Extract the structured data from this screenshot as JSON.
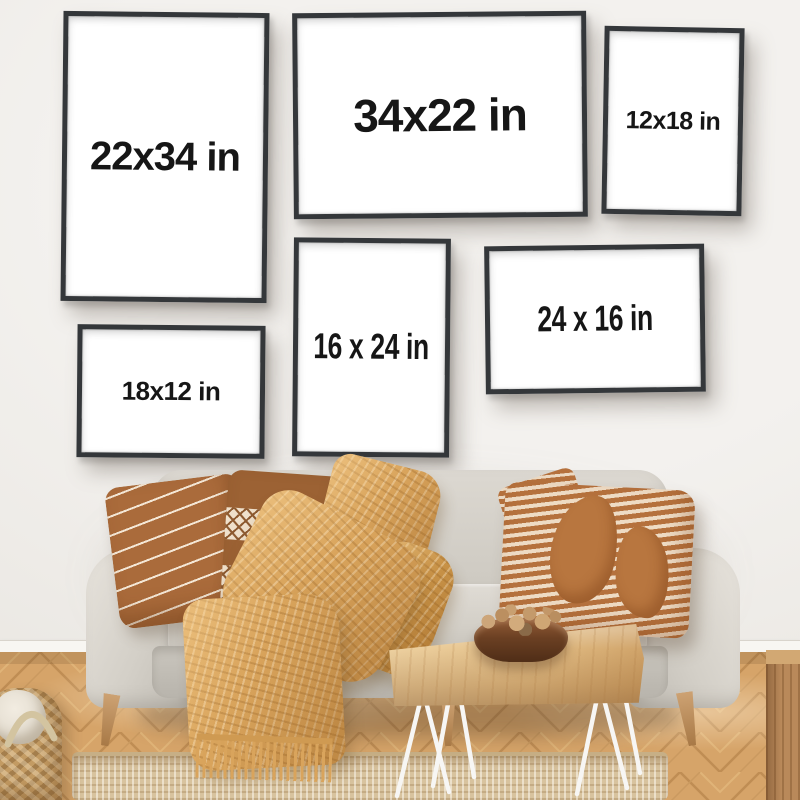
{
  "frames": [
    {
      "name": "frame-22x34",
      "label": "22x34 in",
      "orientation": "portrait"
    },
    {
      "name": "frame-34x22",
      "label": "34x22 in",
      "orientation": "landscape"
    },
    {
      "name": "frame-12x18",
      "label": "12x18 in",
      "orientation": "portrait"
    },
    {
      "name": "frame-16x24",
      "label": "16 x 24 in",
      "orientation": "portrait"
    },
    {
      "name": "frame-24x16",
      "label": "24 x 16 in",
      "orientation": "landscape"
    },
    {
      "name": "frame-18x12",
      "label": "18x12 in",
      "orientation": "landscape"
    }
  ],
  "colors": {
    "wall": "#efedea",
    "frame_border": "#34373a",
    "poster": "#ffffff",
    "label_text": "#161616",
    "sofa_fabric": "#d5d1c9",
    "pillow_rust": "#aa6b3b",
    "pillow_cream": "#f0e2cf",
    "throw_blanket": "#d9a45c",
    "floor_oak": "#d6a569",
    "rug_jute": "#d8c39e",
    "table_wood": "#e2bd85",
    "bowl_wood": "#6b4023",
    "hairpin_legs": "#f7f6f4"
  },
  "objects": [
    "sofa",
    "striped-pillow",
    "diamond-pillow",
    "patterned-pillow",
    "waffle-throw-blanket",
    "coffee-table",
    "nut-bowl",
    "jute-rug",
    "wicker-basket",
    "herringbone-floor",
    "wooden-side-table"
  ]
}
